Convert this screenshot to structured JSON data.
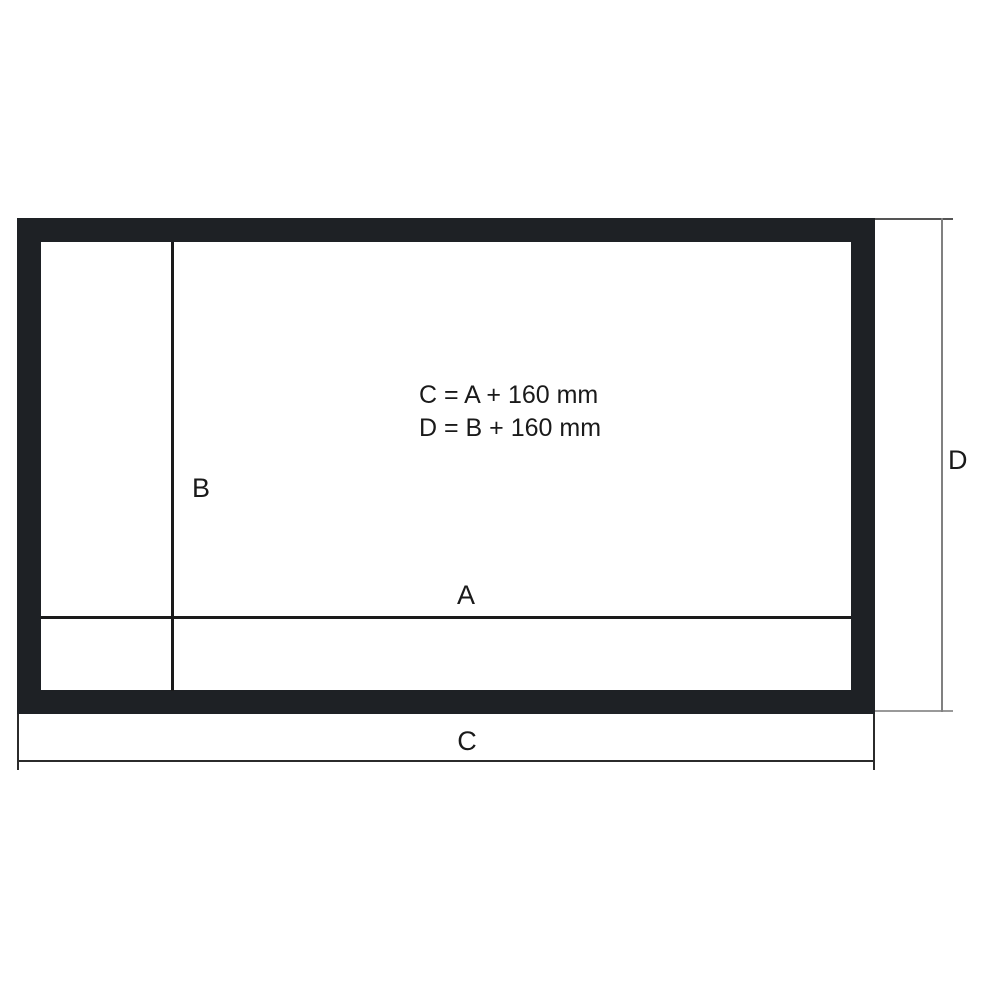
{
  "diagram": {
    "labels": {
      "viewing_width": "A",
      "viewing_height": "B",
      "outer_width": "C",
      "outer_height": "D"
    },
    "formulas": {
      "outer_width_formula": "C = A + 160 mm",
      "outer_height_formula": "D = B + 160 mm"
    },
    "colors": {
      "frame": "#1e2125",
      "inner_line": "#1a1a1a",
      "c_dimension_line": "#2b2b2b",
      "d_dimension_line": "#808080",
      "background": "#ffffff"
    }
  }
}
